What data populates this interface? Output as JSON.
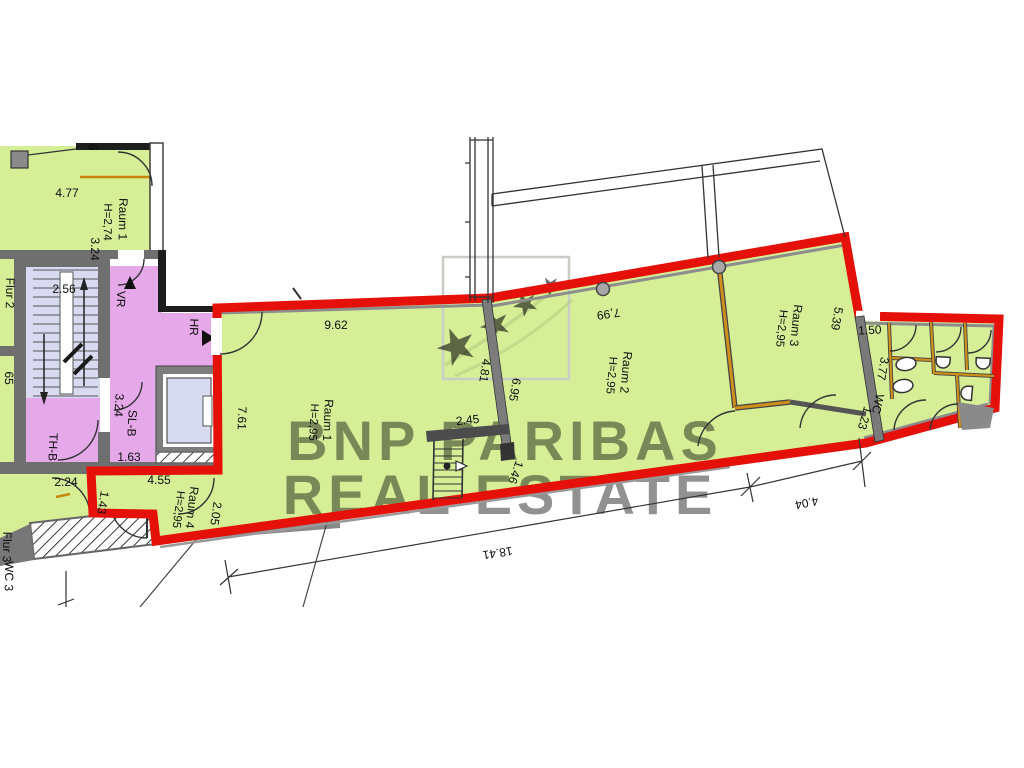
{
  "watermark": {
    "line1": "BNP PARIBAS",
    "line2": "REAL ESTATE"
  },
  "icons": {
    "star": "★"
  },
  "colors": {
    "room_green": "#d6ef97",
    "hall_purple": "#e5a9e9",
    "stair_lavender": "#d8daf2",
    "elevator_cab": "#d8dbf0",
    "outline_red": "#e41009",
    "wall_gray": "#757575",
    "wall_dark": "#333333",
    "partition_orange": "#cf8f1b",
    "window_orange": "#c8860a",
    "watermark_green": "#75826b",
    "logo_star": "#a9c37c",
    "logo_frame": "#c9cdc5",
    "column_gray": "#a8a8a8"
  },
  "labels": {
    "dim_4_77": "4.77",
    "raum1a_name": "Raum 1",
    "raum1a_h": "H=2,74",
    "dim_3_24a": "3.24",
    "dim_6": "6",
    "flur2": "Flur 2",
    "dim_2_56": "2.56",
    "vr": "VR",
    "hr": "HR",
    "slb": "SL-B",
    "dim_3_24b": "3.24",
    "thb": "TH-B",
    "dim_1_63": "1.63",
    "dim_2_24": "2.24",
    "dim_1_43": "1.43",
    "dim_4_55": "4.55",
    "raum4_name": "Raum 4",
    "raum4_h": "H=2,95",
    "dim_2_05": "2.05",
    "dim_9_62": "9.62",
    "raum1b_name": "Raum 1",
    "raum1b_h": "H=2,95",
    "dim_7_61": "7.61",
    "dim_2_45": "2.45",
    "dim_4_81": "4.81",
    "dim_6_95": "6.95",
    "dim_1_46": "1.46",
    "dim_7_99": "7,99",
    "raum2_name": "Raum 2",
    "raum2_h": "H=2,95",
    "raum3_name": "Raum 3",
    "raum3_h": "H=2,95",
    "dim_5_39": "5.39",
    "dim_1_50": "1.50",
    "dim_3_77": "3.77",
    "wc": "WC",
    "dim_1_23": "1.23",
    "dim_18_41": "18.41",
    "dim_4_04": "4.04",
    "partial_65": "65",
    "partial_flur3": "Flur 3",
    "partial_wc3": "WC 3"
  }
}
